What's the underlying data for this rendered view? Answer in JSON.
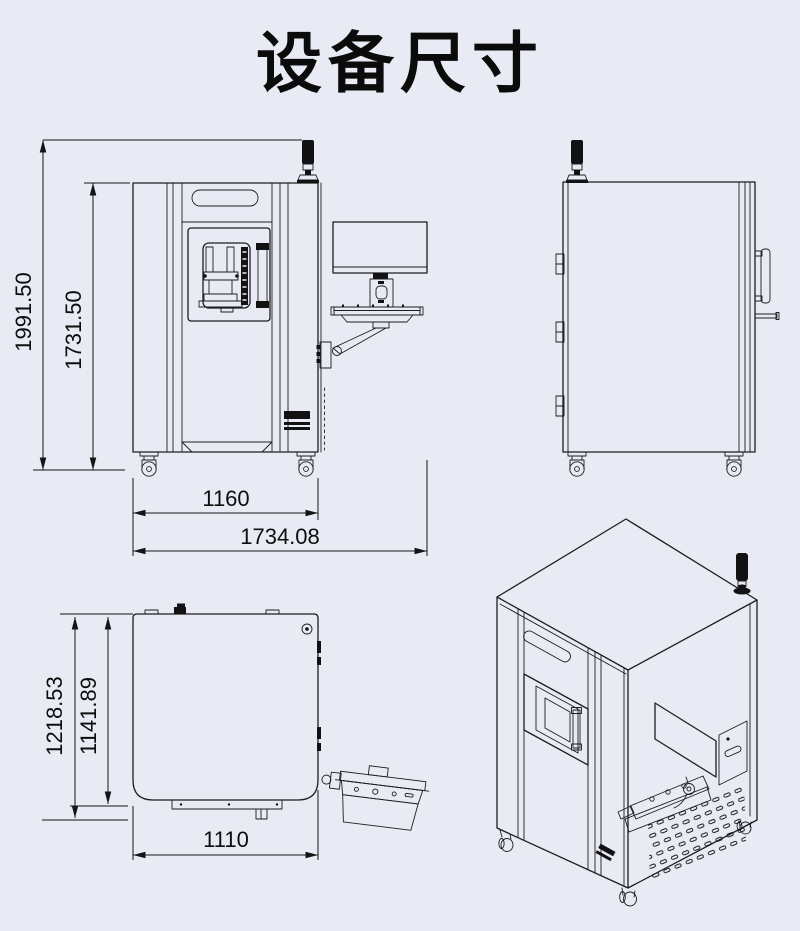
{
  "title": "设备尺寸",
  "colors": {
    "background": "#e9ebf4",
    "line": "#1d1d1f",
    "dark_fill": "#121214"
  },
  "views": {
    "front": {
      "dimensions": {
        "total_height": "1991.50",
        "body_height": "1731.50",
        "body_width": "1160",
        "total_width": "1734.08"
      }
    },
    "top": {
      "dimensions": {
        "total_depth": "1218.53",
        "body_depth": "1141.89",
        "body_width": "1110"
      }
    }
  }
}
